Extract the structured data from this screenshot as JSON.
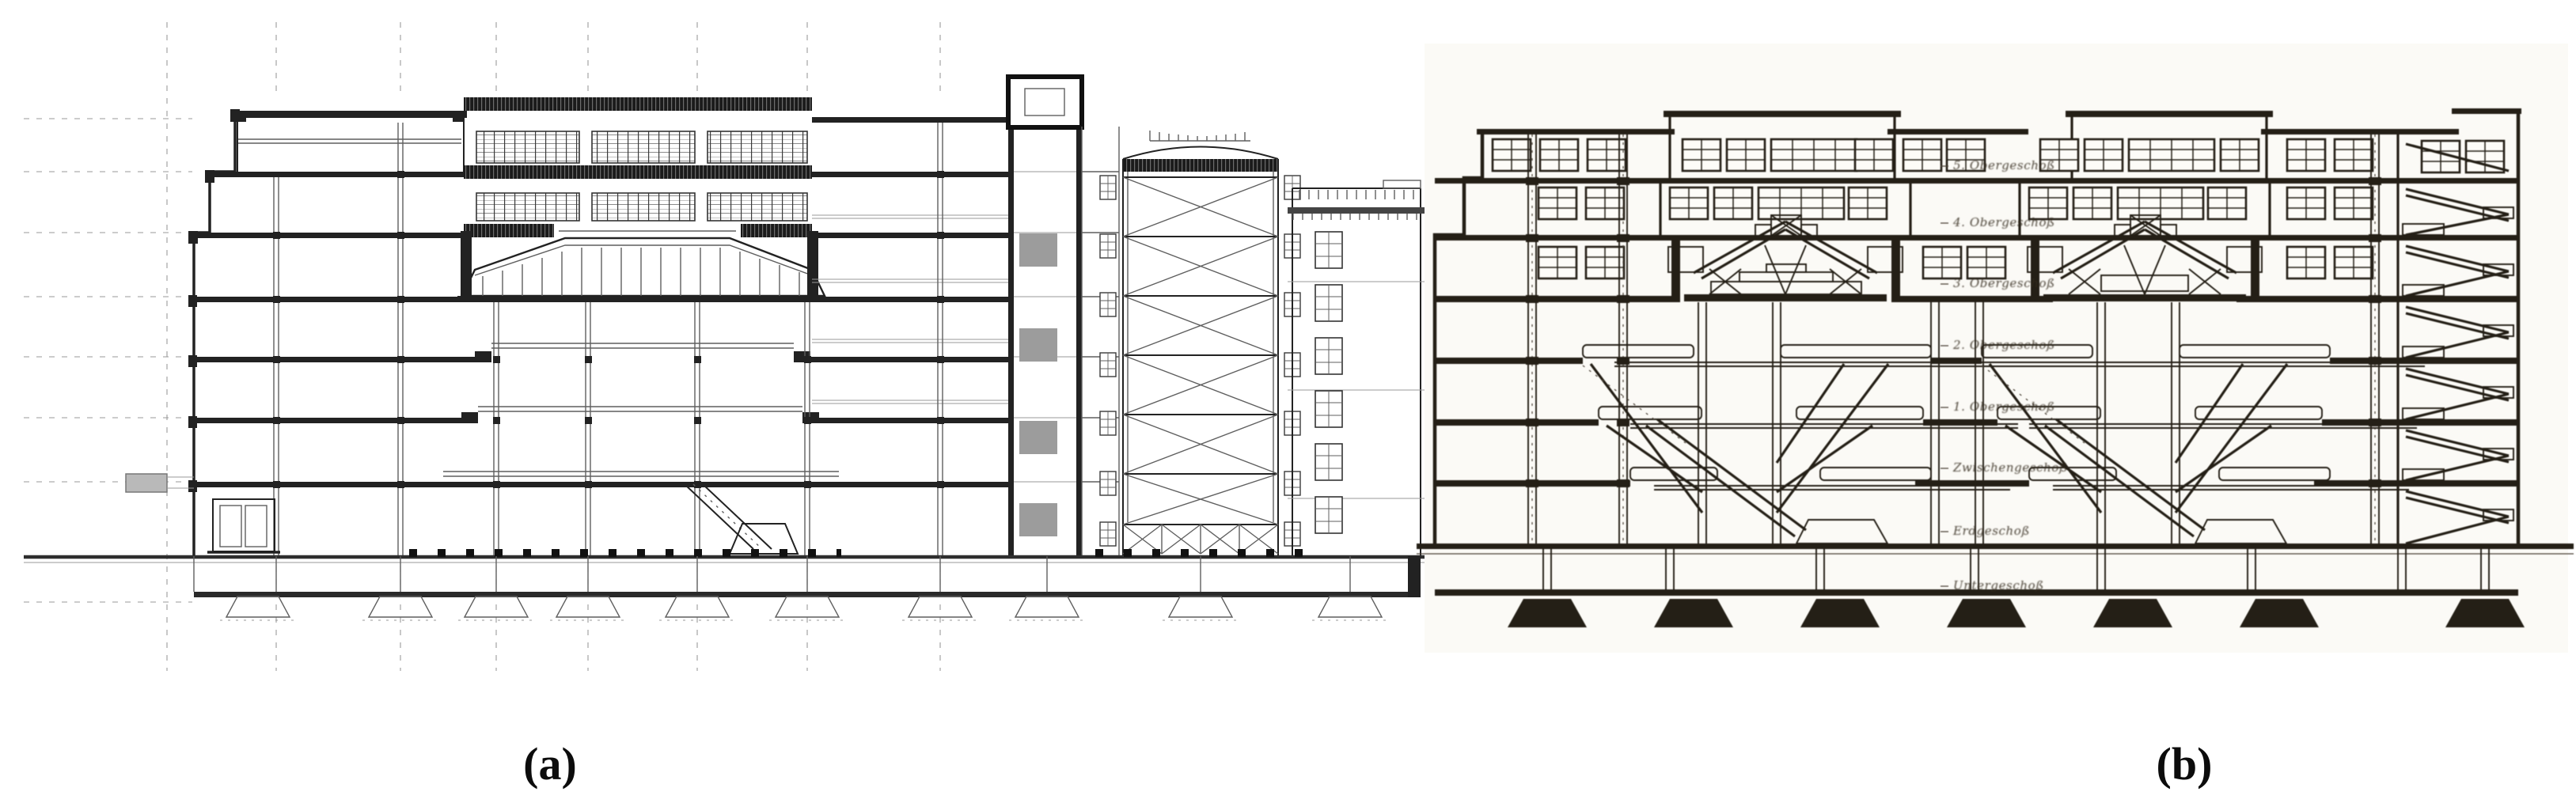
{
  "figure": {
    "background": "#ffffff",
    "panel_a": {
      "caption": "(a)",
      "ink": "#222222"
    },
    "panel_b": {
      "caption": "(b)",
      "ink": "#241f16",
      "floor_labels": [
        "5. Obergeschoß",
        "4. Obergeschoß",
        "3. Obergeschoß",
        "2. Obergeschoß",
        "1. Obergeschoß",
        "Zwischengeschoß",
        "Erdgeschoß",
        "Untergeschoß"
      ]
    }
  }
}
